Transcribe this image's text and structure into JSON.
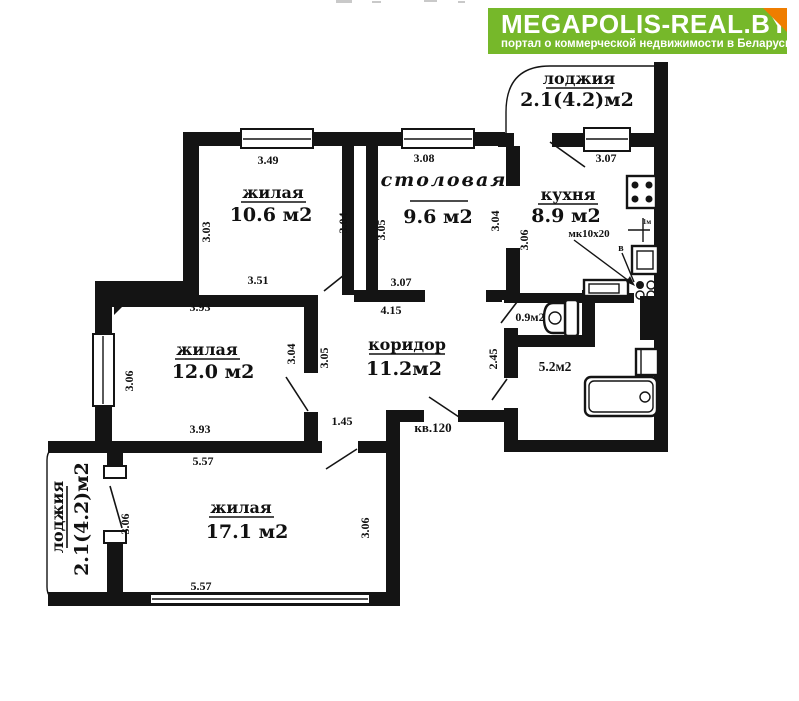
{
  "logo": {
    "title": "MEGAPOLIS-REAL.BY",
    "subtitle": "портал о коммерческой недвижимости в Беларуси",
    "colors": {
      "bg": "#76b82a",
      "fold": "#ef7d00",
      "text": "#ffffff"
    }
  },
  "plan": {
    "apartment_label": "кв.120",
    "line_color": "#141414",
    "rooms": {
      "loggia_top": {
        "name": "лоджия",
        "area": "2.1(4.2)м2"
      },
      "living1": {
        "name": "жилая",
        "area": "10.6 м2"
      },
      "dining": {
        "name": "столовая",
        "area": "9.6 м2"
      },
      "kitchen": {
        "name": "кухня",
        "area": "8.9 м2",
        "note": "мк10х20"
      },
      "living2": {
        "name": "жилая",
        "area": "12.0 м2"
      },
      "corridor": {
        "name": "коридор",
        "area": "11.2м2"
      },
      "wc": {
        "area": "0.9м2"
      },
      "bathroom": {
        "area": "5.2м2"
      },
      "living3": {
        "name": "жилая",
        "area": "17.1 м2"
      },
      "loggia_bottom": {
        "name": "лоджия",
        "area": "2.1(4.2)м2"
      }
    },
    "dimensions": {
      "living1_top": "3.49",
      "living1_left": "3.03",
      "living1_right": "3.04",
      "living1_bottom": "3.51",
      "dining_top": "3.08",
      "dining_left": "3.05",
      "dining_right": "3.04",
      "dining_bottom": "3.07",
      "corridor_top": "4.15",
      "corridor_pass": "1.45",
      "corridor_right": "2.45",
      "kitchen_top": "3.07",
      "kitchen_left": "3.06",
      "living2_top": "3.93",
      "living2_left": "3.06",
      "living2_right": "3.04",
      "living2_outer": "3.05",
      "living2_bottom": "3.93",
      "living3_top": "5.57",
      "living3_left": "3.06",
      "living3_right": "3.06",
      "living3_bottom": "5.57",
      "vent_width": "1м",
      "vent_letter": "в"
    }
  }
}
